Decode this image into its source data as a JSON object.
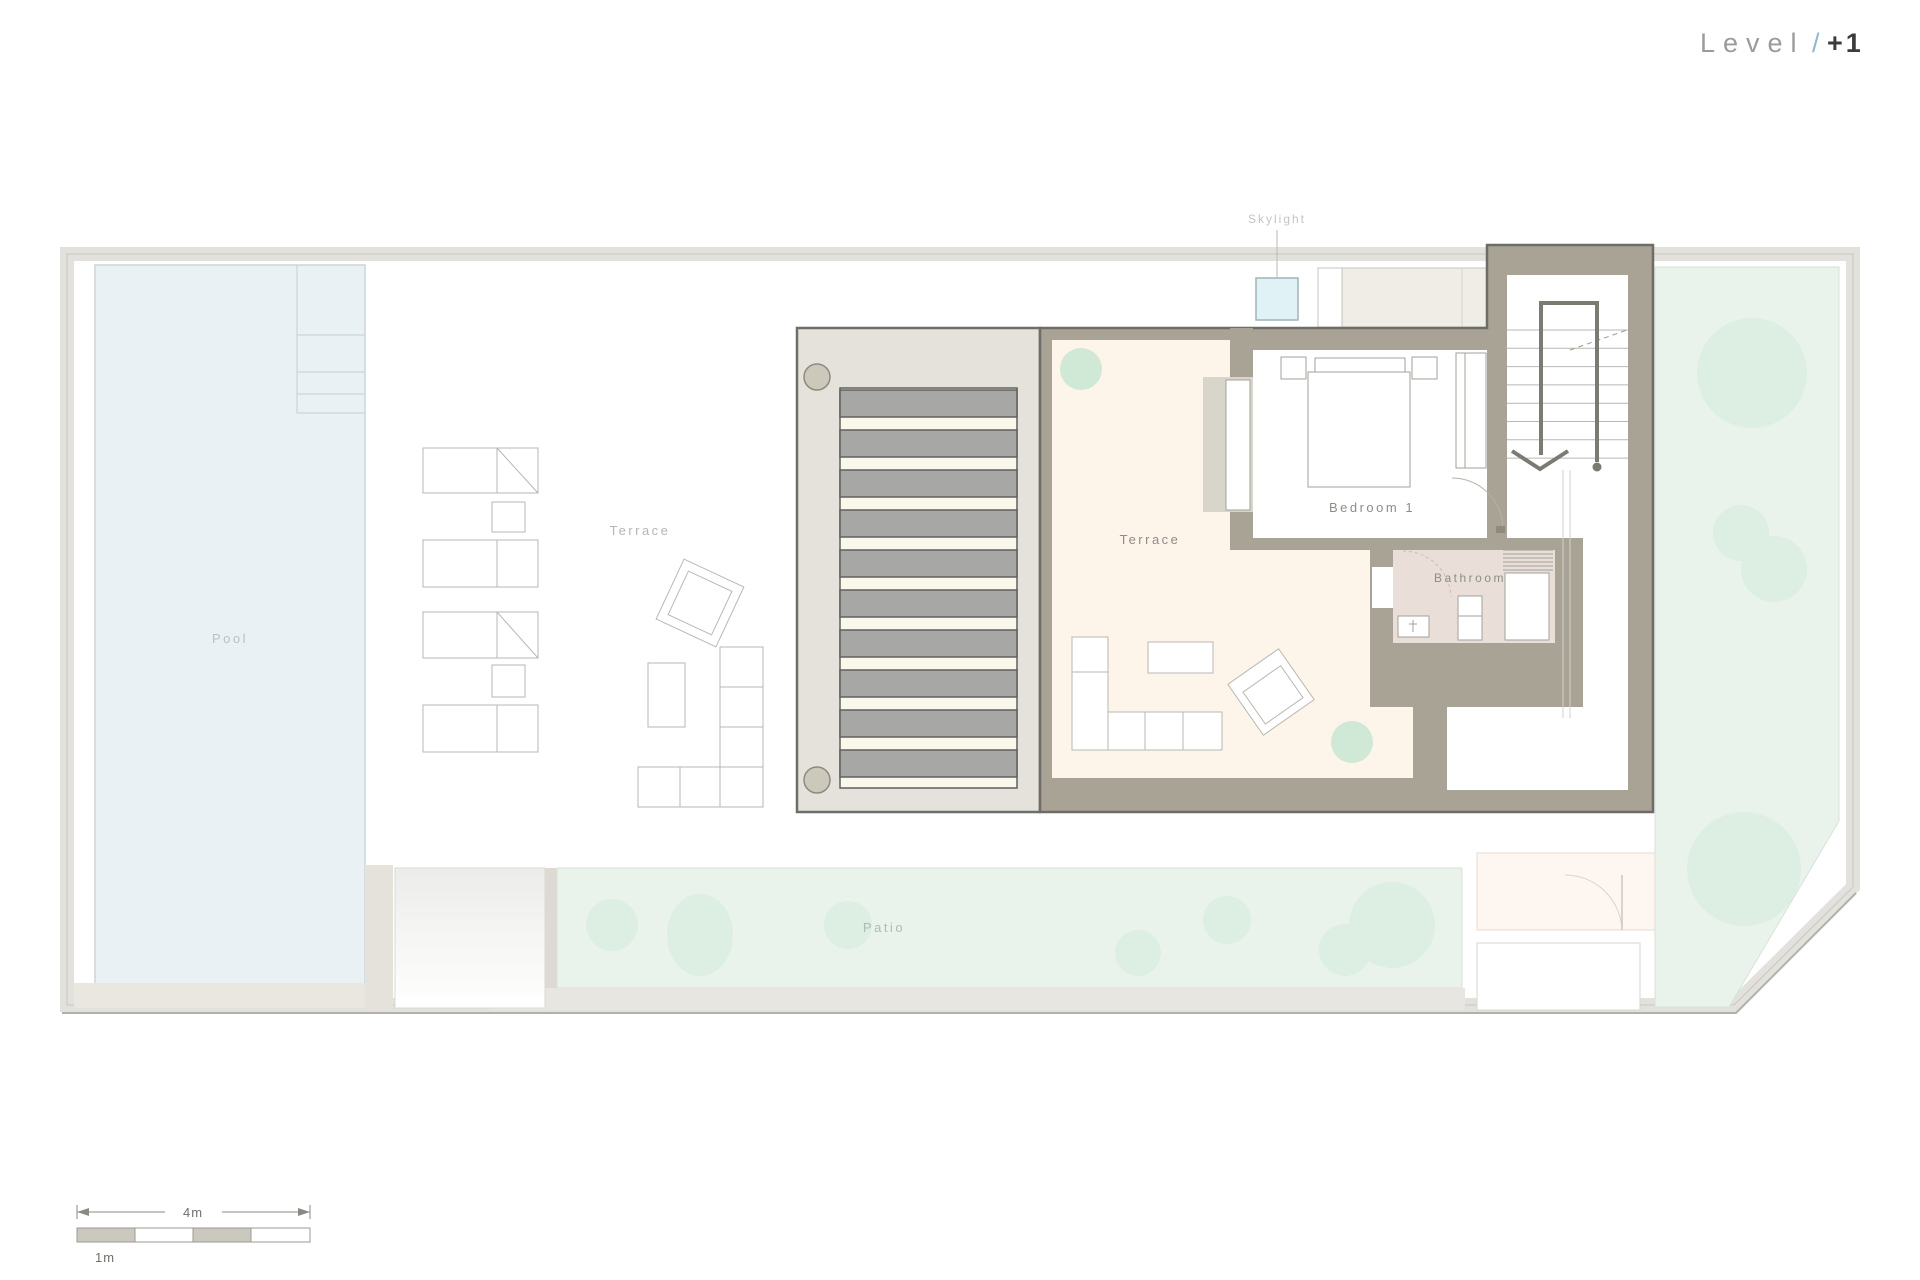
{
  "title": {
    "prefix": "Level",
    "slash": "/",
    "number": "+1"
  },
  "labels": {
    "pool": "Pool",
    "terrace_left": "Terrace",
    "terrace_main": "Terrace",
    "bedroom": "Bedroom 1",
    "bathroom": "Bathroom",
    "skylight": "Skylight",
    "patio": "Patio"
  },
  "scale_bar": {
    "total": "4m",
    "unit": "1m"
  },
  "pergola": {
    "slat_count": 10
  },
  "stairs": {
    "tread_count": 8
  },
  "colors": {
    "outer_band": "#e3e1db",
    "wall_taupe": "#a9a396",
    "wall_outline": "#6d6d66",
    "pool_fill": "#e9f1f4",
    "green_fill": "#e9f3ec",
    "tree_fill": "#d9ecdf",
    "cream_floor": "#fdf4ea",
    "bath_floor": "#eadfd8",
    "slat_gray": "#a7a8a5",
    "skylight_fill": "#e1f2f6",
    "accent_slash": "#8fb9cc"
  }
}
